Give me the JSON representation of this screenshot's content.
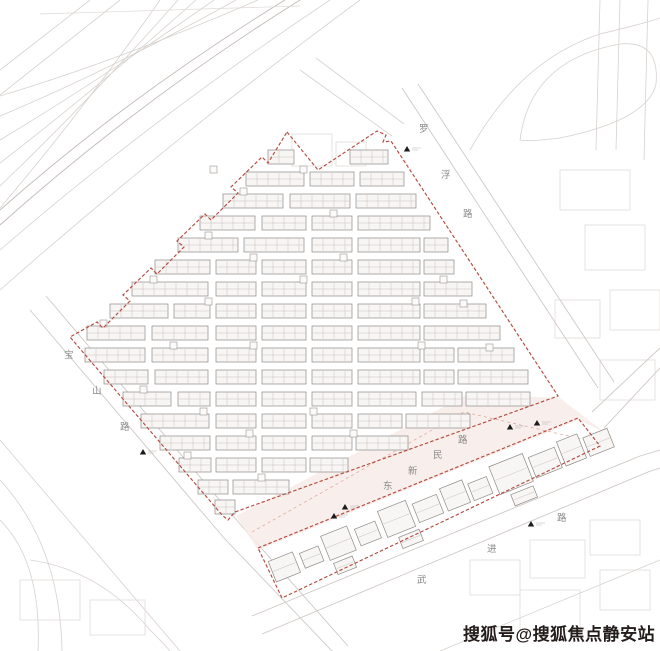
{
  "watermark": {
    "text": "搜狐号@搜狐焦点静安站",
    "color": "#241d1b"
  },
  "palette": {
    "boundary_red": "#b5493d",
    "band_fill": "#f7ebe8",
    "building_fill": "#f7f6f4",
    "building_stroke": "#8f8a87",
    "context_line": "#d7d1ce",
    "label_gray": "#8a8a8a",
    "marker_black": "#1c1c1c"
  },
  "roads": [
    {
      "name": "baoshan-road",
      "label": "宝山路",
      "chars": [
        {
          "t": "宝",
          "x": 64,
          "y": 358
        },
        {
          "t": "山",
          "x": 92,
          "y": 394
        },
        {
          "t": "路",
          "x": 120,
          "y": 430
        }
      ]
    },
    {
      "name": "luofu-road",
      "label": "罗浮路",
      "chars": [
        {
          "t": "罗",
          "x": 419,
          "y": 132
        },
        {
          "t": "浮",
          "x": 441,
          "y": 178
        },
        {
          "t": "路",
          "x": 463,
          "y": 217
        }
      ]
    },
    {
      "name": "dongxinmin-road",
      "label": "东新民路",
      "chars": [
        {
          "t": "东",
          "x": 383,
          "y": 489
        },
        {
          "t": "新",
          "x": 408,
          "y": 474
        },
        {
          "t": "民",
          "x": 433,
          "y": 458
        },
        {
          "t": "路",
          "x": 458,
          "y": 443
        }
      ]
    },
    {
      "name": "wujin-road",
      "label": "武进路",
      "chars": [
        {
          "t": "武",
          "x": 417,
          "y": 583
        },
        {
          "t": "进",
          "x": 487,
          "y": 552
        },
        {
          "t": "路",
          "x": 557,
          "y": 521
        }
      ]
    }
  ],
  "site": {
    "main_boundary": "M 287 132 L 318 170 L 377 131 L 386 135 L 383 142 L 391 141 L 558 396 L 235 512 L 228 520 L 222 515 L 70 337 L 97 322 L 103 328 L 130 301 L 123 295 L 151 268 L 157 274 L 184 247 L 177 241 L 205 214 L 211 220 L 238 193 L 231 187 L 262 157 L 268 163 Z",
    "strip_boundary": "M 258 548 L 578 418 L 600 446 L 446 520 L 282 598 Z",
    "band_polygon": "236,516 468,394 560,398 604,432 578,420 258,550",
    "band_midline": "M 252 532 L 464 412 L 586 440",
    "building_height": 14,
    "rows": [
      {
        "y": 150,
        "segs": [
          [
            268,
            26
          ],
          [
            350,
            38
          ]
        ]
      },
      {
        "y": 172,
        "segs": [
          [
            246,
            58
          ],
          [
            310,
            44
          ],
          [
            360,
            44
          ]
        ]
      },
      {
        "y": 194,
        "segs": [
          [
            223,
            60
          ],
          [
            290,
            60
          ],
          [
            356,
            60
          ]
        ]
      },
      {
        "y": 216,
        "segs": [
          [
            200,
            55
          ],
          [
            262,
            44
          ],
          [
            312,
            40
          ],
          [
            358,
            72
          ]
        ]
      },
      {
        "y": 238,
        "segs": [
          [
            178,
            60
          ],
          [
            244,
            60
          ],
          [
            312,
            40
          ],
          [
            358,
            62
          ],
          [
            424,
            24
          ]
        ]
      },
      {
        "y": 260,
        "segs": [
          [
            155,
            55
          ],
          [
            216,
            40
          ],
          [
            262,
            44
          ],
          [
            312,
            40
          ],
          [
            358,
            62
          ],
          [
            424,
            30
          ]
        ]
      },
      {
        "y": 282,
        "segs": [
          [
            132,
            76
          ],
          [
            216,
            40
          ],
          [
            262,
            44
          ],
          [
            312,
            40
          ],
          [
            358,
            62
          ],
          [
            424,
            48
          ]
        ]
      },
      {
        "y": 304,
        "segs": [
          [
            110,
            58
          ],
          [
            174,
            36
          ],
          [
            216,
            40
          ],
          [
            262,
            44
          ],
          [
            312,
            40
          ],
          [
            358,
            62
          ],
          [
            424,
            62
          ]
        ]
      },
      {
        "y": 326,
        "segs": [
          [
            87,
            58
          ],
          [
            152,
            56
          ],
          [
            216,
            40
          ],
          [
            262,
            44
          ],
          [
            312,
            40
          ],
          [
            358,
            62
          ],
          [
            424,
            76
          ]
        ]
      },
      {
        "y": 348,
        "segs": [
          [
            85,
            60
          ],
          [
            152,
            56
          ],
          [
            216,
            40
          ],
          [
            262,
            44
          ],
          [
            312,
            40
          ],
          [
            358,
            62
          ],
          [
            424,
            30
          ],
          [
            458,
            56
          ]
        ]
      },
      {
        "y": 370,
        "segs": [
          [
            104,
            44
          ],
          [
            155,
            53
          ],
          [
            216,
            40
          ],
          [
            262,
            44
          ],
          [
            312,
            40
          ],
          [
            358,
            62
          ],
          [
            424,
            30
          ],
          [
            458,
            70
          ]
        ]
      },
      {
        "y": 392,
        "segs": [
          [
            123,
            48
          ],
          [
            178,
            32
          ],
          [
            216,
            40
          ],
          [
            262,
            44
          ],
          [
            312,
            40
          ],
          [
            358,
            58
          ],
          [
            422,
            40
          ],
          [
            466,
            64
          ]
        ]
      },
      {
        "y": 414,
        "segs": [
          [
            141,
            68
          ],
          [
            216,
            40
          ],
          [
            262,
            44
          ],
          [
            312,
            40
          ],
          [
            358,
            44
          ],
          [
            406,
            64
          ]
        ]
      },
      {
        "y": 436,
        "segs": [
          [
            160,
            50
          ],
          [
            216,
            40
          ],
          [
            262,
            44
          ],
          [
            312,
            40
          ],
          [
            356,
            52
          ]
        ]
      },
      {
        "y": 458,
        "segs": [
          [
            179,
            32
          ],
          [
            216,
            40
          ],
          [
            262,
            44
          ],
          [
            310,
            38
          ]
        ]
      },
      {
        "y": 480,
        "segs": [
          [
            198,
            30
          ],
          [
            233,
            56
          ]
        ]
      },
      {
        "y": 500,
        "segs": [
          [
            215,
            20
          ]
        ]
      }
    ],
    "squares": [
      [
        210,
        166
      ],
      [
        300,
        166
      ],
      [
        240,
        188
      ],
      [
        330,
        210
      ],
      [
        205,
        232
      ],
      [
        250,
        254
      ],
      [
        150,
        276
      ],
      [
        100,
        320
      ],
      [
        205,
        298
      ],
      [
        300,
        276
      ],
      [
        340,
        254
      ],
      [
        412,
        298
      ],
      [
        440,
        276
      ],
      [
        200,
        408
      ],
      [
        246,
        430
      ],
      [
        310,
        408
      ],
      [
        184,
        452
      ],
      [
        258,
        474
      ],
      [
        350,
        430
      ],
      [
        140,
        386
      ],
      [
        418,
        342
      ],
      [
        250,
        342
      ],
      [
        170,
        342
      ],
      [
        460,
        300
      ],
      [
        486,
        344
      ]
    ],
    "strip_buildings": {
      "origin": [
        266,
        556
      ],
      "angle": -21.8,
      "rects": [
        [
          0,
          6,
          26,
          22
        ],
        [
          32,
          10,
          20,
          16
        ],
        [
          58,
          2,
          28,
          26
        ],
        [
          92,
          8,
          22,
          18
        ],
        [
          120,
          0,
          30,
          28
        ],
        [
          155,
          6,
          26,
          20
        ],
        [
          186,
          2,
          24,
          24
        ],
        [
          214,
          8,
          20,
          18
        ],
        [
          240,
          0,
          36,
          30
        ],
        [
          280,
          6,
          28,
          22
        ],
        [
          312,
          2,
          22,
          26
        ],
        [
          338,
          8,
          26,
          20
        ],
        [
          60,
          32,
          20,
          12
        ],
        [
          130,
          32,
          22,
          12
        ],
        [
          250,
          34,
          24,
          12
        ]
      ]
    },
    "markers": [
      [
        407,
        146
      ],
      [
        143,
        449
      ],
      [
        345,
        504
      ],
      [
        334,
        513
      ],
      [
        510,
        424
      ],
      [
        537,
        420
      ],
      [
        531,
        521
      ]
    ]
  }
}
